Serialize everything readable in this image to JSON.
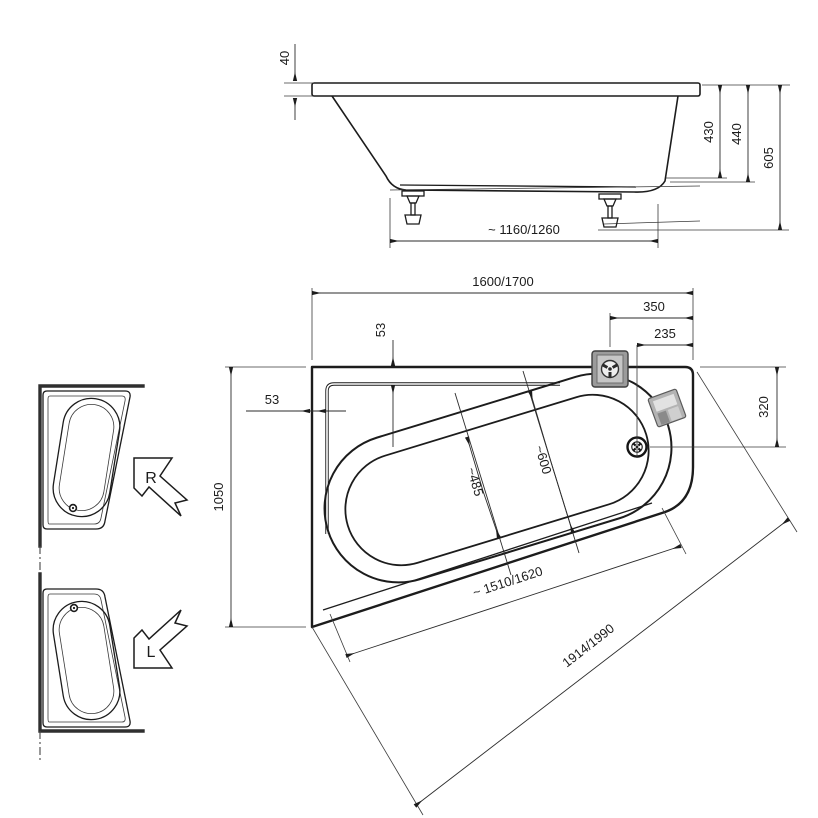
{
  "drawing": {
    "side_view": {
      "rim_thickness": "40",
      "depth_inner": "430",
      "shell_height": "440",
      "total_height": "605",
      "feet_spacing": "~ 1160/1260"
    },
    "plan_view": {
      "overall_length": "1600/1700",
      "faucet_offset": "350",
      "drain_offset": "235",
      "rim_width_top": "53",
      "rim_width_left": "53",
      "overall_width": "1050",
      "right_edge": "320",
      "well_width": "~485",
      "opening_width": "~600",
      "front_edge_inner": "~ 1510/1620",
      "front_edge_overall": "1914/1990"
    },
    "variants": {
      "right": "R",
      "left": "L"
    },
    "icons": [
      "faucet-icon",
      "overflow-icon",
      "drain-icon",
      "variant-arrow-right-icon",
      "variant-arrow-left-icon"
    ],
    "colors": {
      "line": "#1c1c1c",
      "dim": "#2b2b2b",
      "fixture_gray": "#9b9b9b"
    }
  }
}
